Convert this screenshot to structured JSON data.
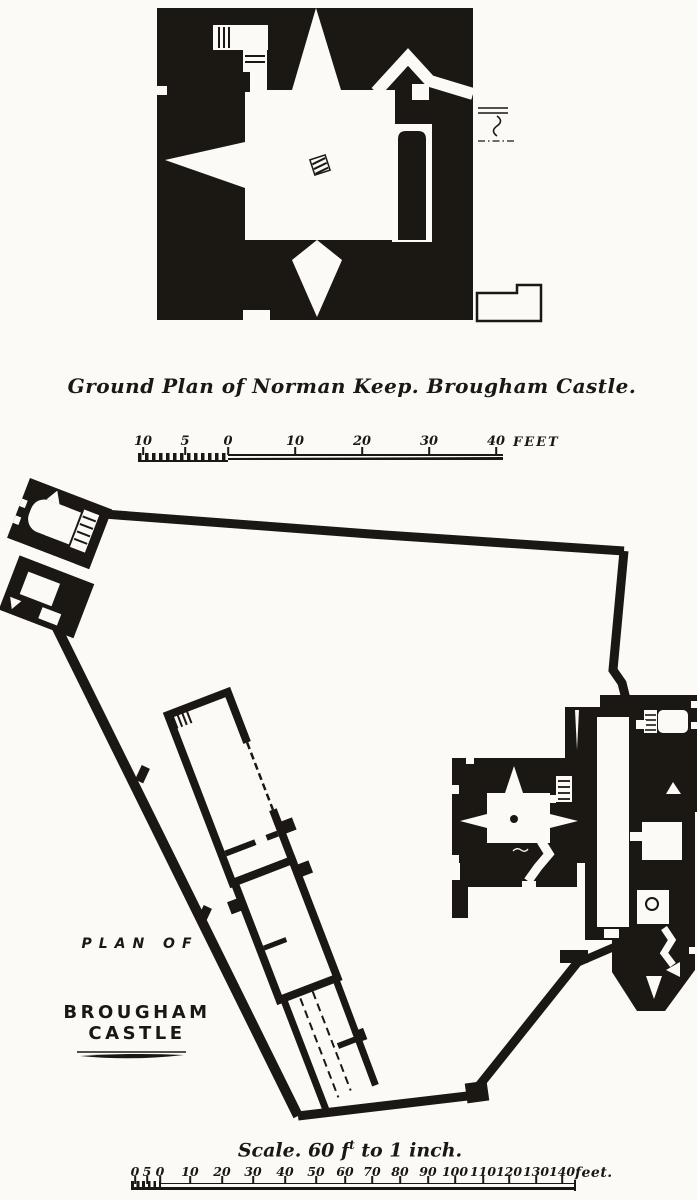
{
  "keep_plan": {
    "caption": "Ground Plan of Norman Keep. Brougham Castle."
  },
  "keep_scale": {
    "labels": [
      "10",
      "5",
      "0",
      "10",
      "20",
      "30",
      "40"
    ],
    "unit": "FEET"
  },
  "castle_plan": {
    "title_line1": "PLAN OF",
    "title_line2": "BROUGHAM CASTLE"
  },
  "castle_scale_caption": {
    "prefix": "Scale. 60 f",
    "superscript": "t",
    "suffix": " to 1 inch."
  },
  "castle_scale": {
    "labels": [
      "0",
      "5",
      "0",
      "10",
      "20",
      "30",
      "40",
      "50",
      "60",
      "70",
      "80",
      "90",
      "100",
      "110",
      "120",
      "130",
      "140"
    ],
    "unit": "feet."
  },
  "colors": {
    "ink": "#1b1713",
    "paper": "#fbfaf7"
  }
}
